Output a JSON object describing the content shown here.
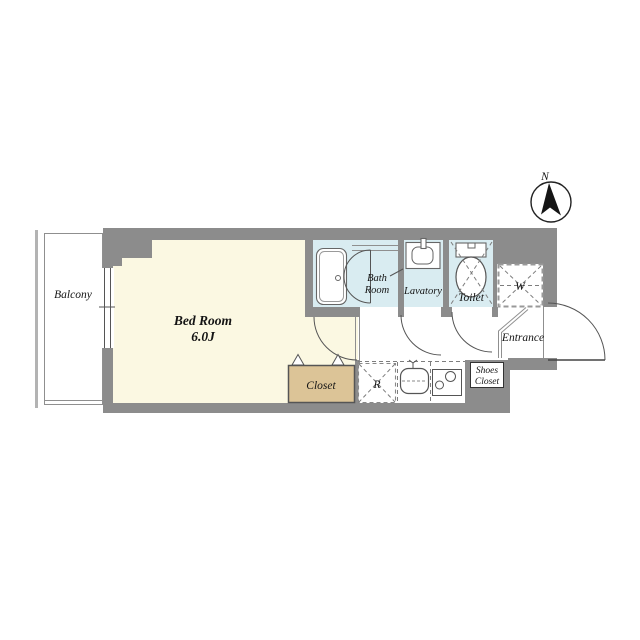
{
  "floorplan": {
    "compass": {
      "north_label": "N"
    },
    "rooms": {
      "balcony": {
        "label": "Balcony"
      },
      "bedroom": {
        "label": "Bed Room",
        "size": "6.0J"
      },
      "bathroom": {
        "label_line1": "Bath",
        "label_line2": "Room"
      },
      "lavatory": {
        "label": "Lavatory"
      },
      "toilet": {
        "label": "Toilet"
      },
      "washer_space": {
        "label": "W"
      },
      "entrance": {
        "label": "Entrance"
      },
      "shoes_closet": {
        "label_line1": "Shoes",
        "label_line2": "Closet"
      },
      "closet": {
        "label": "Closet"
      },
      "refrigerator_space": {
        "label": "R"
      }
    },
    "colors": {
      "wall": "#8c8c8c",
      "bedroom": "#fbf8e2",
      "wet": "#d9ecf1",
      "closet": "#dcc497",
      "line": "#555555"
    }
  }
}
